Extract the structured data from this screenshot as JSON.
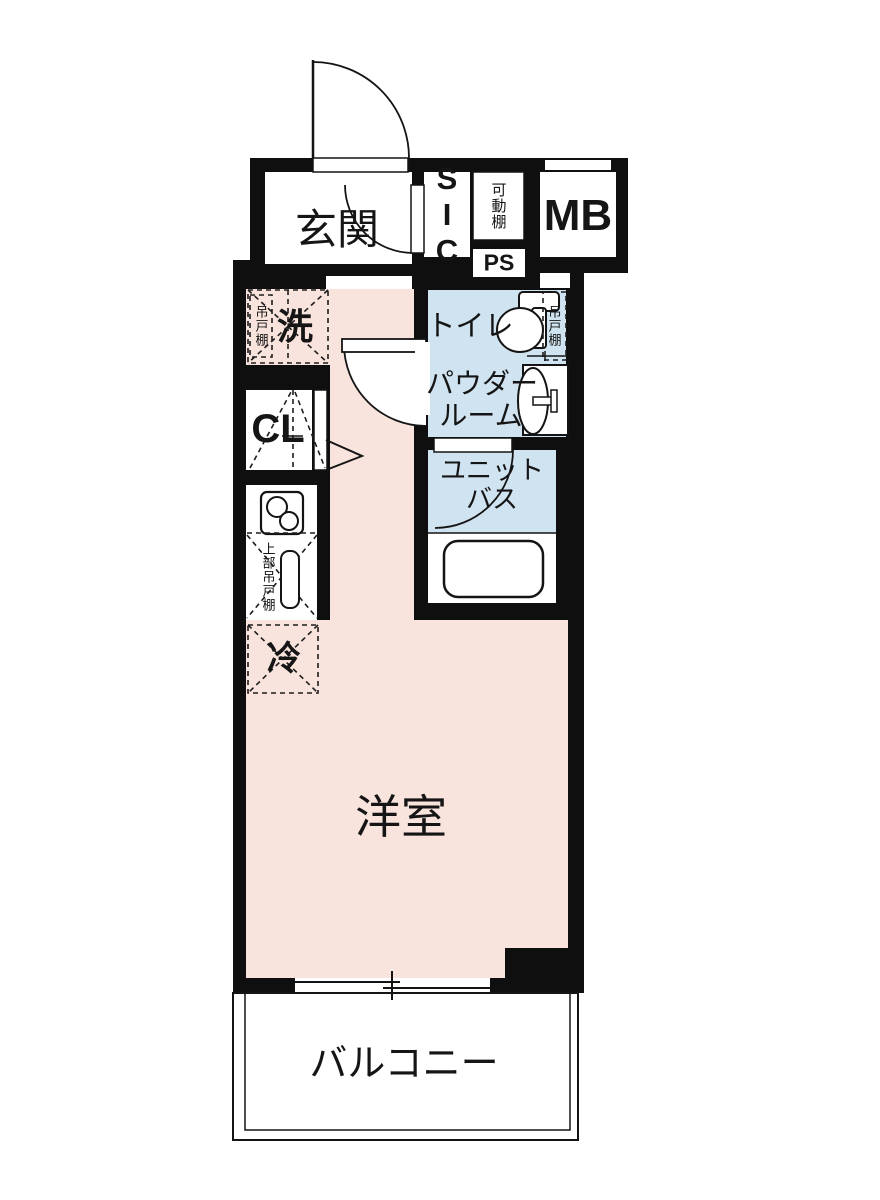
{
  "title": "1R apartment floor plan",
  "rooms": {
    "genkan": "玄関",
    "sic": "SIC",
    "movable_shelf": "可動棚",
    "mb": "MB",
    "ps": "PS",
    "washer": "洗",
    "washer_cupboard": "吊戸棚",
    "toilet": "トイレ",
    "toilet_cupboard": "吊戸棚",
    "powder_room_line1": "パウダー",
    "powder_room_line2": "ルーム",
    "closet": "CL",
    "unit_bath_line1": "ユニット",
    "unit_bath_line2": "バス",
    "kitchen_upper_cupboard": "上部吊戸棚",
    "refrigerator": "冷",
    "western_room": "洋室",
    "balcony": "バルコニー"
  },
  "colors": {
    "room_pink": "#f9e4dd",
    "wet_area_blue": "#cfe3f0",
    "wall": "#0f0f0f",
    "background": "#ffffff"
  }
}
